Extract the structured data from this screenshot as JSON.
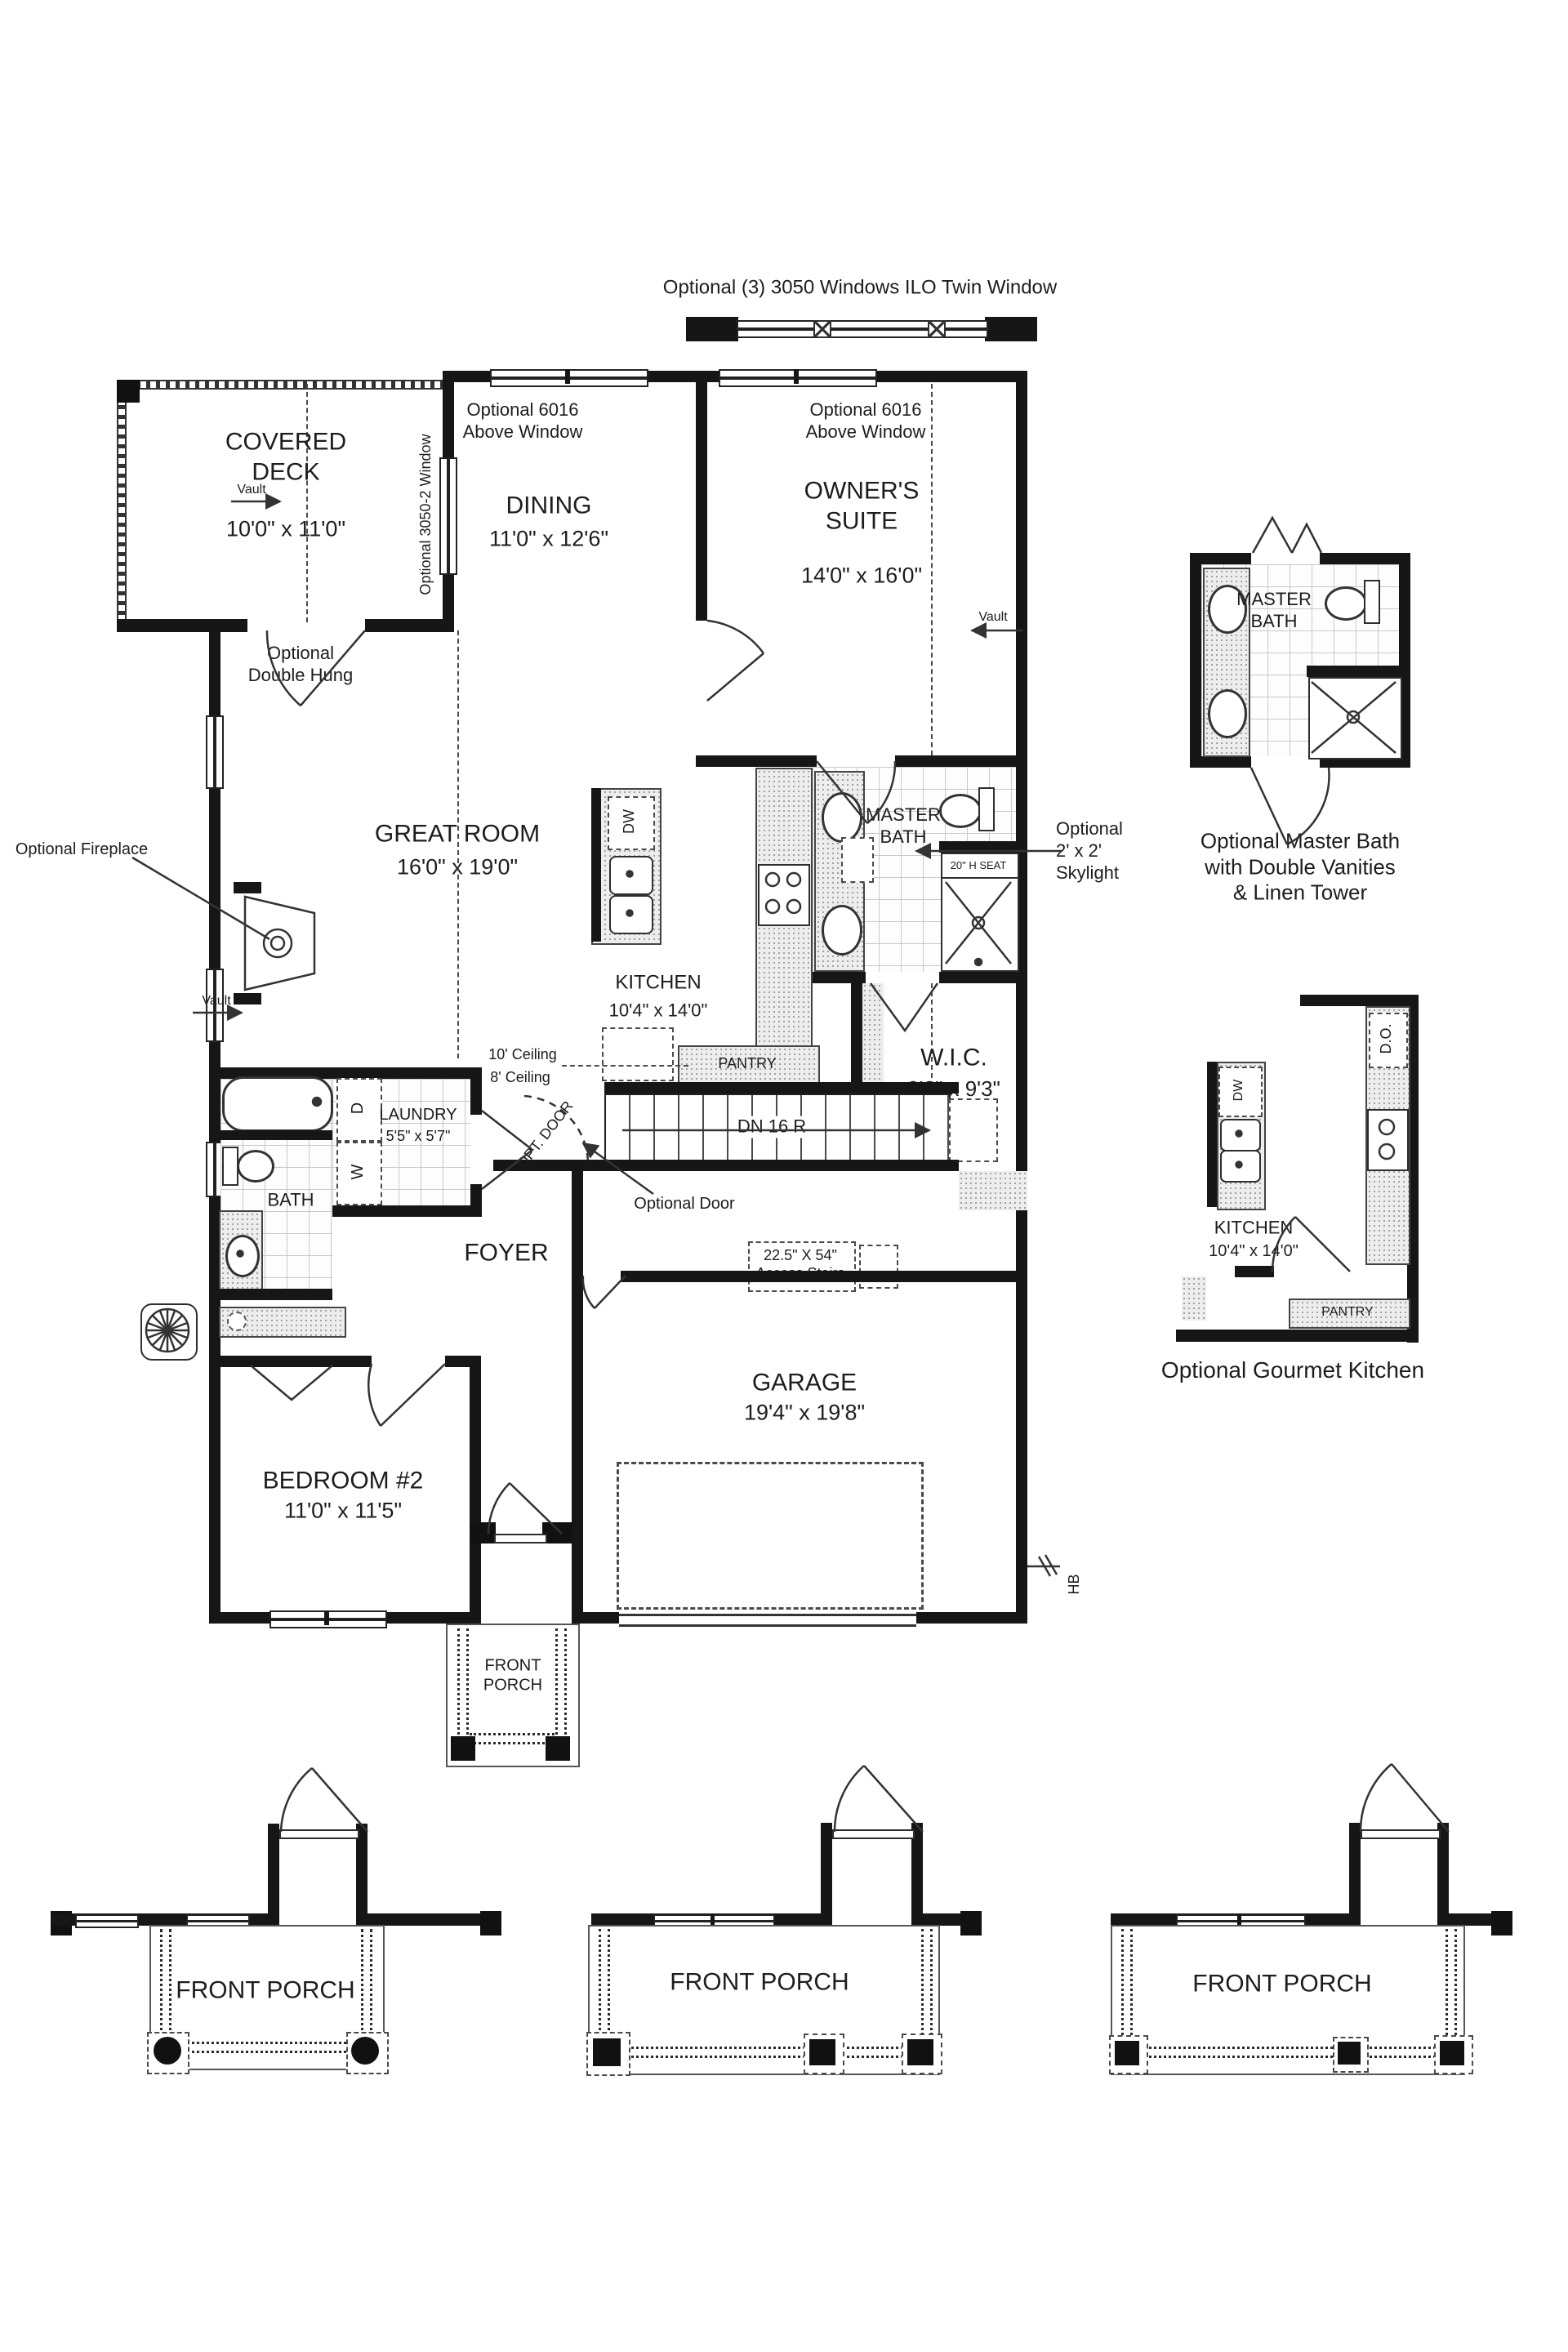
{
  "annotations": {
    "top_note": "Optional (3) 3050 Windows ILO Twin Window",
    "optional_6016": "Optional 6016\nAbove Window",
    "optional_3050_2": "Optional 3050-2 Window",
    "optional_double_hung": "Optional\nDouble Hung",
    "vault": "Vault",
    "optional_fireplace": "Optional Fireplace",
    "skylight": "Optional\n2' x 2'\nSkylight",
    "seat": "20\" H SEAT",
    "stairs_down": "DN 16 R",
    "pantry": "PANTRY",
    "ceiling_10": "10' Ceiling",
    "ceiling_8": "8' Ceiling",
    "opt_door": "OPT. DOOR",
    "optional_door": "Optional Door",
    "access_stairs": "22.5\" X 54\"\nAccess Stairs",
    "dishwasher": "DW",
    "washer": "W",
    "dryer": "D",
    "hose_bib": "HB"
  },
  "rooms": {
    "covered_deck": {
      "name": "COVERED\nDECK",
      "dims": "10'0\" x 11'0\""
    },
    "dining": {
      "name": "DINING",
      "dims": "11'0\" x 12'6\""
    },
    "owners_suite": {
      "name": "OWNER'S\nSUITE",
      "dims": "14'0\" x 16'0\""
    },
    "great_room": {
      "name": "GREAT ROOM",
      "dims": "16'0\" x 19'0\""
    },
    "kitchen": {
      "name": "KITCHEN",
      "dims": "10'4\" x 14'0\""
    },
    "master_bath": {
      "name": "MASTER\nBATH"
    },
    "wic": {
      "name": "W.I.C.",
      "dims": "9'0\" x 9'3\""
    },
    "laundry": {
      "name": "LAUNDRY",
      "dims": "5'5\" x 5'7\""
    },
    "bath": {
      "name": "BATH"
    },
    "foyer": {
      "name": "FOYER"
    },
    "garage": {
      "name": "GARAGE",
      "dims": "19'4\" x 19'8\""
    },
    "bedroom2": {
      "name": "BEDROOM #2",
      "dims": "11'0\" x 11'5\""
    },
    "front_porch_small": {
      "name": "FRONT\nPORCH"
    }
  },
  "insets": {
    "master_bath": {
      "room": "MASTER\nBATH",
      "caption": "Optional Master Bath\nwith Double Vanities\n& Linen Tower"
    },
    "gourmet_kitchen": {
      "room": "KITCHEN",
      "dims": "10'4\" x 14'0\"",
      "pantry": "PANTRY",
      "dishwasher": "DW",
      "double_oven": "D.O.",
      "caption": "Optional Gourmet Kitchen"
    }
  },
  "porch_options": [
    {
      "label": "FRONT PORCH"
    },
    {
      "label": "FRONT PORCH"
    },
    {
      "label": "FRONT PORCH"
    }
  ],
  "colors": {
    "wall": "#161616",
    "line": "#333333",
    "text": "#1d1d1d"
  }
}
